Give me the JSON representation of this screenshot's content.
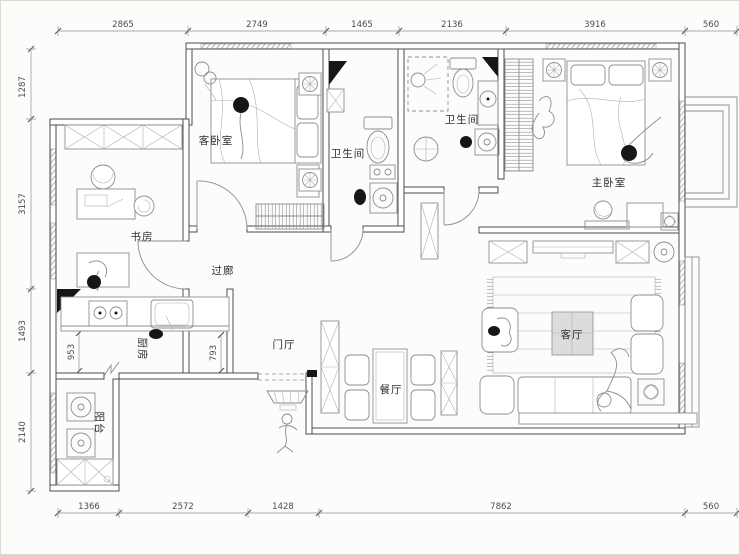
{
  "plan": {
    "type": "apartment-floor-plan",
    "rooms": {
      "guest_bedroom": "客卧室",
      "bathroom_a": "卫生间",
      "bathroom_b": "卫生间",
      "master_bedroom": "主卧室",
      "study": "书房",
      "corridor": "过廊",
      "kitchen": "厨房",
      "entry": "门厅",
      "dining": "餐厅",
      "living": "客厅",
      "balcony": "阳台"
    },
    "dims": {
      "top": [
        "2865",
        "2749",
        "1465",
        "2136",
        "3916",
        "560"
      ],
      "left": [
        "1287",
        "3157",
        "1493",
        "2140"
      ],
      "bottom": [
        "1366",
        "2572",
        "1428",
        "7862",
        "560"
      ],
      "interior": [
        "953",
        "793"
      ]
    },
    "colors": {
      "wall_line": "#4c4c4c",
      "furniture_line": "#8d8d8d",
      "dimension_line": "#8f8f8f",
      "label_text": "#2d2d2d",
      "background": "#fcfcfa",
      "column_black": "#161616",
      "coffee_table_fill": "#dcdcdc"
    }
  }
}
